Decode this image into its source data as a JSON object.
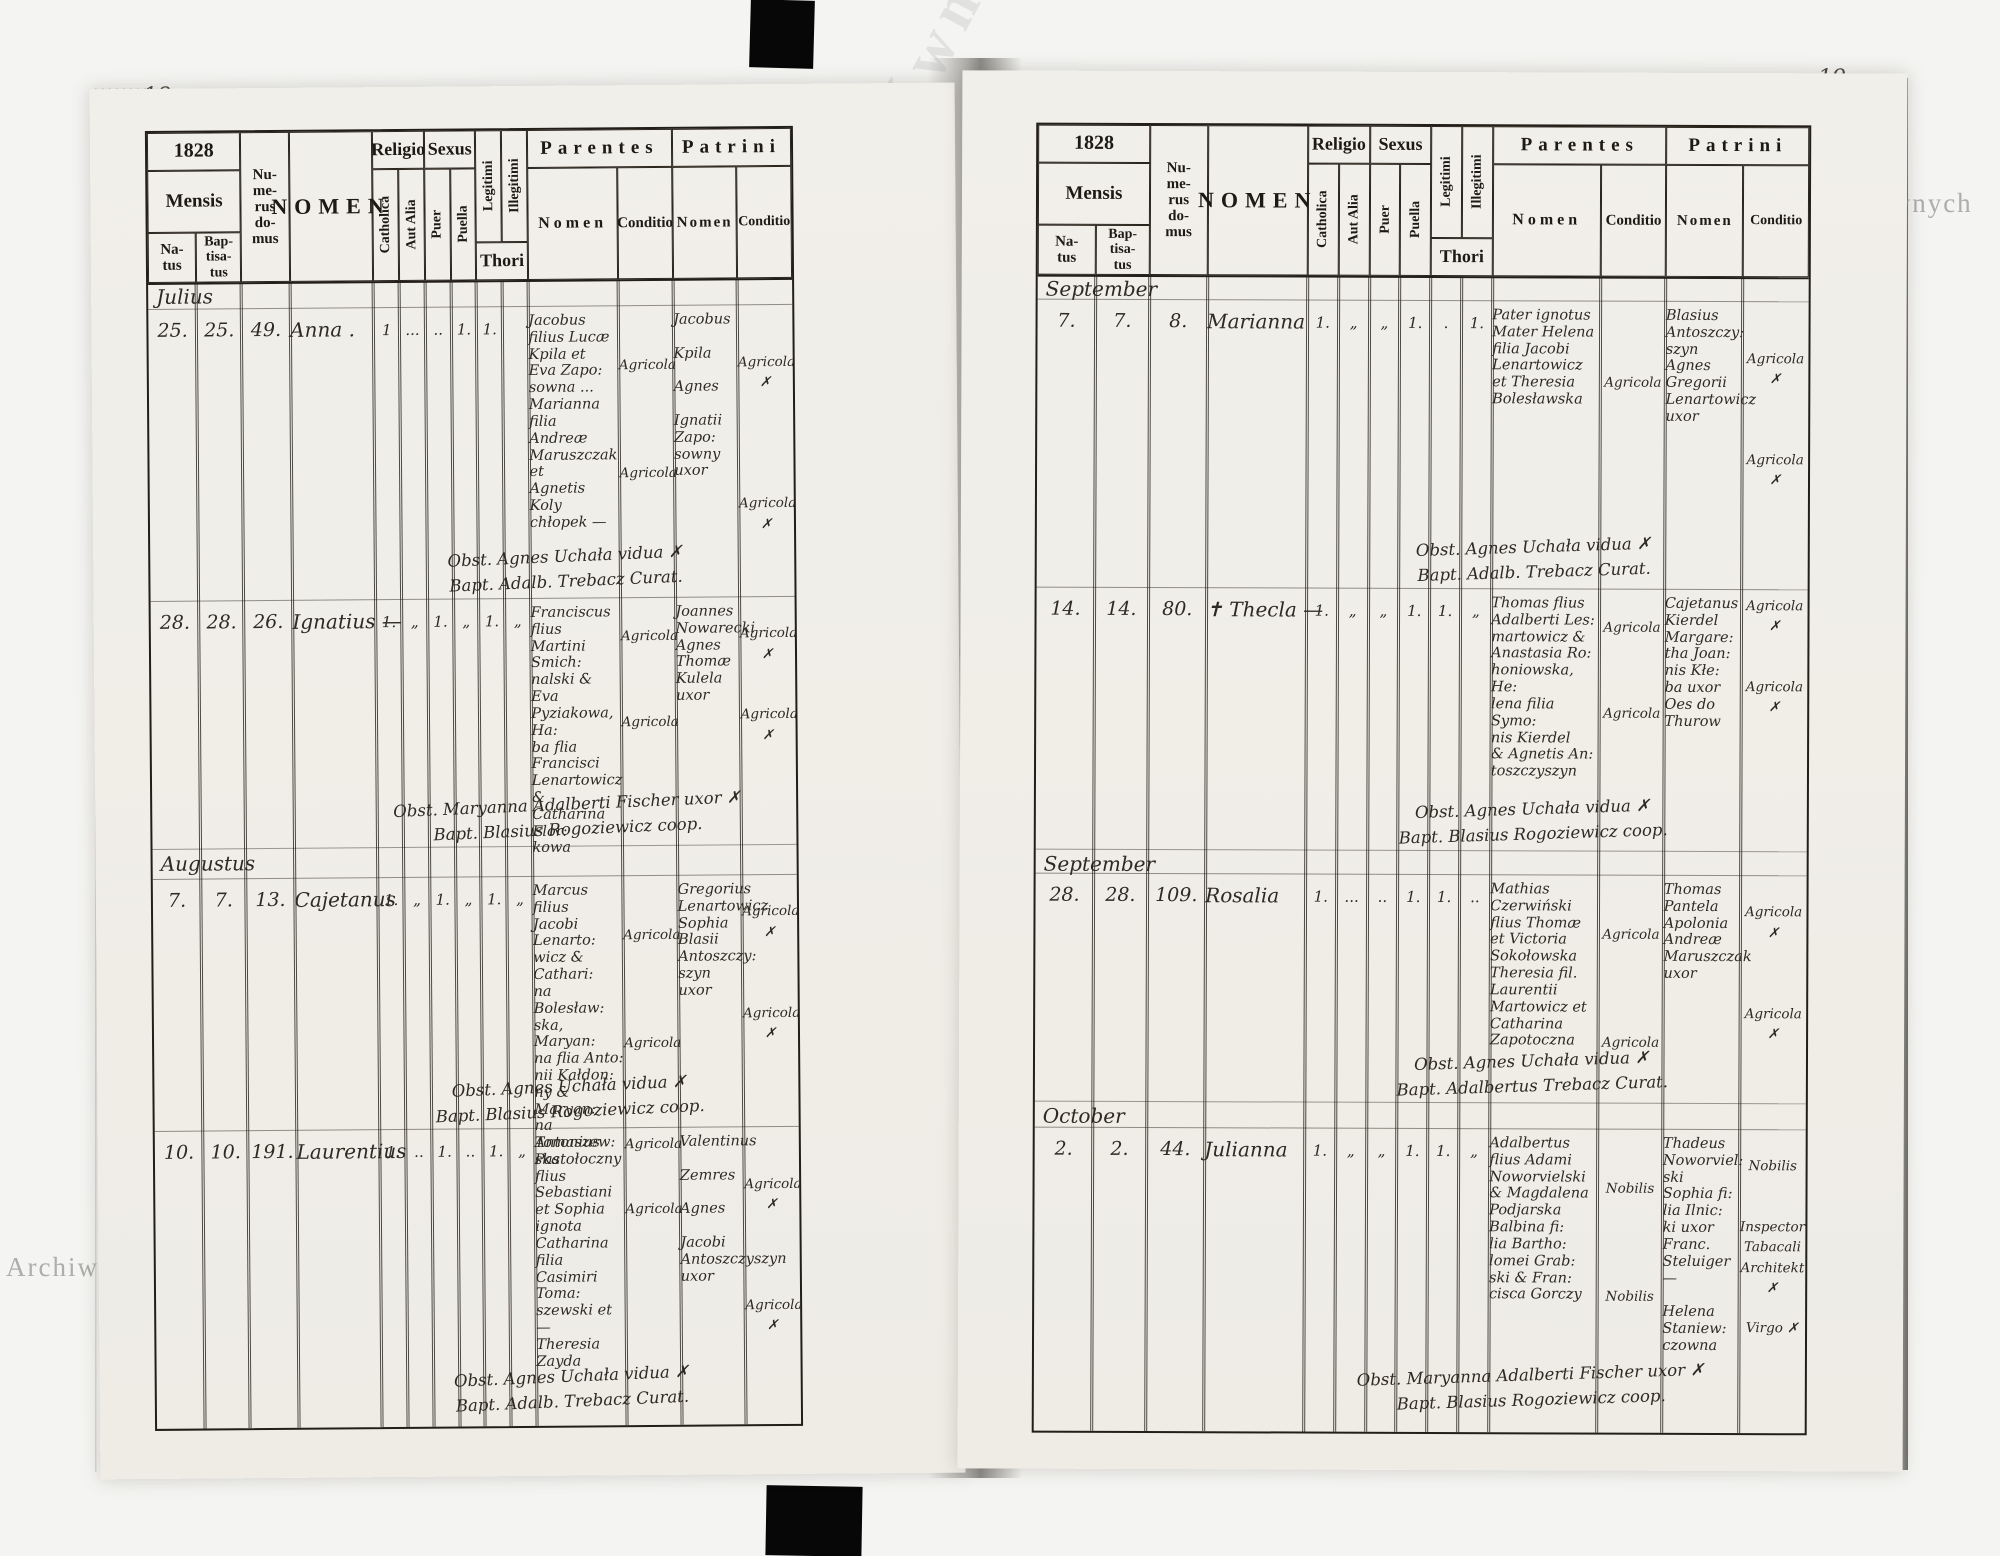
{
  "watermark": {
    "text": "Archiwum Główne Akt Dawnych"
  },
  "corners": {
    "left_top": "18.",
    "right_top": "19.",
    "left_bottom": "18",
    "right_bottom": "19"
  },
  "header": {
    "year": "1828",
    "mensis": "Mensis",
    "natus": "Na-\ntus",
    "baptisatus": "Bap-\ntisa-\ntus",
    "numerus_domus": "Nu-\nme-\nrus\ndo-\nmus",
    "nomen": "NOMEN",
    "religio": "Religio",
    "catholica": "Catholica",
    "aut_alia": "Aut Alia",
    "sexus": "Sexus",
    "puer": "Puer",
    "puella": "Puella",
    "legitimi": "Legitimi",
    "illegitimi": "Illegitimi",
    "thori": "Thori",
    "parentes": "Parentes",
    "patrini": "Patrini",
    "sub_nomen": "Nomen",
    "sub_conditio": "Conditio"
  },
  "left": {
    "entries": [
      {
        "month": "Julius",
        "natus": "25.",
        "baptisatus": "25.",
        "domus": "49.",
        "nomen": "Anna .",
        "catholica": "1",
        "aut_alia": "...",
        "puer": "..",
        "puella": "1.",
        "legitimi": "1.",
        "illegitimi": "",
        "parentes_nomen": "Jacobus\nfilius Lucæ\nKpila et\nEva Zapo:\nsowna ...\nMarianna\nfilia Andreæ\nMaruszczak et\nAgnetis Koly\nchłopek —",
        "parentes_conditio": "\n\nAgricola\n\n\n\n\nAgricola",
        "patrini_nomen": "Jacobus\n\nKpila\n\nAgnes\n\nIgnatii\nZapo:\nsowny\nuxor",
        "patrini_conditio": "\n\nAgricola ✗\n\n\n\n\n\nAgricola ✗",
        "obstetrix": "Obst. Agnes Uchała vidua ✗",
        "baptizans": "Bapt. Adalb. Trebacz Curat."
      },
      {
        "month": "",
        "natus": "28.",
        "baptisatus": "28.",
        "domus": "26.",
        "nomen": "Ignatius —",
        "catholica": "1.",
        "aut_alia": "„",
        "puer": "1.",
        "puella": "„",
        "legitimi": "1.",
        "illegitimi": "„",
        "parentes_nomen": "Franciscus flius\nMartini Smich:\nnalski & Eva\nPyziakowa, Ha:\nba flia Francisci\nLenartowicz &\nCatharina Flor:\nkowa",
        "parentes_conditio": "\nAgricola\n\n\n\nAgricola",
        "patrini_nomen": "Joannes\nNowarecki\nAgnes\nThomæ\nKulela\nuxor",
        "patrini_conditio": "\nAgricola ✗\n\n\nAgricola ✗",
        "obstetrix": "Obst. Maryanna Adalberti Fischer uxor ✗",
        "baptizans": "Bapt. Blasius Rogoziewicz coop."
      },
      {
        "month": "Augustus",
        "natus": "7.",
        "baptisatus": "7.",
        "domus": "13.",
        "nomen": "Cajetanus",
        "catholica": "1.",
        "aut_alia": "„",
        "puer": "1.",
        "puella": "„",
        "legitimi": "1.",
        "illegitimi": "„",
        "parentes_nomen": "Marcus filius\nJacobi Lenarto:\nwicz & Cathari:\nna Bolesław:\nska, Maryan:\nna flia Anto:\nnii Kałdon:\nny & Maryan:\nna Tomaszew:\nska",
        "parentes_conditio": "\n\nAgricola\n\n\n\n\nAgricola",
        "patrini_nomen": "Gregorius\nLenartowicz\nSophia\nBlasii\nAntoszczy:\nszyn uxor",
        "patrini_conditio": "\nAgricola ✗\n\n\n\nAgricola ✗",
        "obstetrix": "Obst. Agnes Uchała vidua ✗",
        "baptizans": "Bapt. Blasius Rogoziewicz coop."
      },
      {
        "month": "",
        "natus": "10.",
        "baptisatus": "10.",
        "domus": "191.",
        "nomen": "Laurentius",
        "catholica": "1.",
        "aut_alia": "..",
        "puer": "1.",
        "puella": "..",
        "legitimi": "1.",
        "illegitimi": "„",
        "parentes_nomen": "Antonius\nPastołoczny\nflius Sebastiani\net Sophia ignota\nCatharina filia\nCasimiri Toma:\nszewski et —\nTheresia Zayda",
        "parentes_conditio": "Agricola\n\n\nAgricola",
        "patrini_nomen": "Valentinus\n\nZemres\n\nAgnes\n\nJacobi\nAntoszczyszyn\nuxor",
        "patrini_conditio": "\n\nAgricola ✗\n\n\n\n\nAgricola ✗",
        "obstetrix": "Obst. Agnes Uchała vidua ✗",
        "baptizans": "Bapt. Adalb. Trebacz Curat."
      }
    ]
  },
  "right": {
    "entries": [
      {
        "month": "September",
        "natus": "7.",
        "baptisatus": "7.",
        "domus": "8.",
        "nomen": "Marianna",
        "catholica": "1.",
        "aut_alia": "„",
        "puer": "„",
        "puella": "1.",
        "legitimi": ".",
        "illegitimi": "1.",
        "parentes_nomen": "Pater ignotus\nMater Helena\nfilia Jacobi\nLenartowicz\net Theresia\nBolesławska",
        "parentes_conditio": "\n\n\nAgricola",
        "patrini_nomen": "Blasius\nAntoszczy:\nszyn\nAgnes\nGregorii\nLenartowicz\nuxor",
        "patrini_conditio": "\n\nAgricola ✗\n\n\n\nAgricola ✗",
        "obstetrix": "Obst. Agnes Uchała vidua ✗",
        "baptizans": "Bapt. Adalb. Trebacz Curat."
      },
      {
        "month": "",
        "natus": "14.",
        "baptisatus": "14.",
        "domus": "80.",
        "nomen": "✝ Thecla —",
        "catholica": "1.",
        "aut_alia": "„",
        "puer": "„",
        "puella": "1.",
        "legitimi": "1.",
        "illegitimi": "„",
        "parentes_nomen": "Thomas flius\nAdalberti Les:\nmartowicz &\nAnastasia Ro:\nhoniowska, He:\nlena filia Symo:\nnis Kierdel\n& Agnetis An:\ntoszczyszyn",
        "parentes_conditio": "\nAgricola\n\n\n\nAgricola",
        "patrini_nomen": "Cajetanus\nKierdel\nMargare:\ntha Joan:\nnis Kłe:\nba uxor\nOes do Thurow",
        "patrini_conditio": "Agricola ✗\n\n\nAgricola ✗",
        "obstetrix": "Obst. Agnes Uchała vidua ✗",
        "baptizans": "Bapt. Blasius Rogoziewicz coop."
      },
      {
        "month": "September",
        "natus": "28.",
        "baptisatus": "28.",
        "domus": "109.",
        "nomen": "Rosalia",
        "catholica": "1.",
        "aut_alia": "...",
        "puer": "..",
        "puella": "1.",
        "legitimi": "1.",
        "illegitimi": "..",
        "parentes_nomen": "Mathias\nCzerwiński\nflius Thomæ\net Victoria\nSokołowska\nTheresia fil.\nLaurentii\nMartowicz et\nCatharina\nZapotoczna",
        "parentes_conditio": "\n\nAgricola\n\n\n\n\nAgricola",
        "patrini_nomen": "Thomas\nPantela\nApolonia\nAndreæ\nMaruszczak\nuxor",
        "patrini_conditio": "\nAgricola ✗\n\n\n\nAgricola ✗",
        "obstetrix": "Obst. Agnes Uchała vidua ✗",
        "baptizans": "Bapt. Adalbertus Trebacz Curat."
      },
      {
        "month": "October",
        "natus": "2.",
        "baptisatus": "2.",
        "domus": "44.",
        "nomen": "Julianna",
        "catholica": "1.",
        "aut_alia": "„",
        "puer": "„",
        "puella": "1.",
        "legitimi": "1.",
        "illegitimi": "„",
        "parentes_nomen": "Adalbertus\nflius Adami\nNoworvielski\n& Magdalena\nPodjarska\nBalbina fi:\nlia Bartho:\nlomei Grab:\nski & Fran:\ncisca Gorczy",
        "parentes_conditio": "\n\nNobilis\n\n\n\n\nNobilis",
        "patrini_nomen": "Thadeus\nNoworviel:\nski\nSophia fi:\nlia Ilnic:\nki uxor\nFranc. Steluiger —\n\nHelena\nStaniew:\nczowna",
        "patrini_conditio": "\nNobilis\n\n\nInspector\nTabacali\nArchitekt ✗\n\nVirgo ✗",
        "obstetrix": "Obst. Maryanna Adalberti Fischer uxor ✗",
        "baptizans": "Bapt. Blasius Rogoziewicz coop."
      }
    ]
  }
}
